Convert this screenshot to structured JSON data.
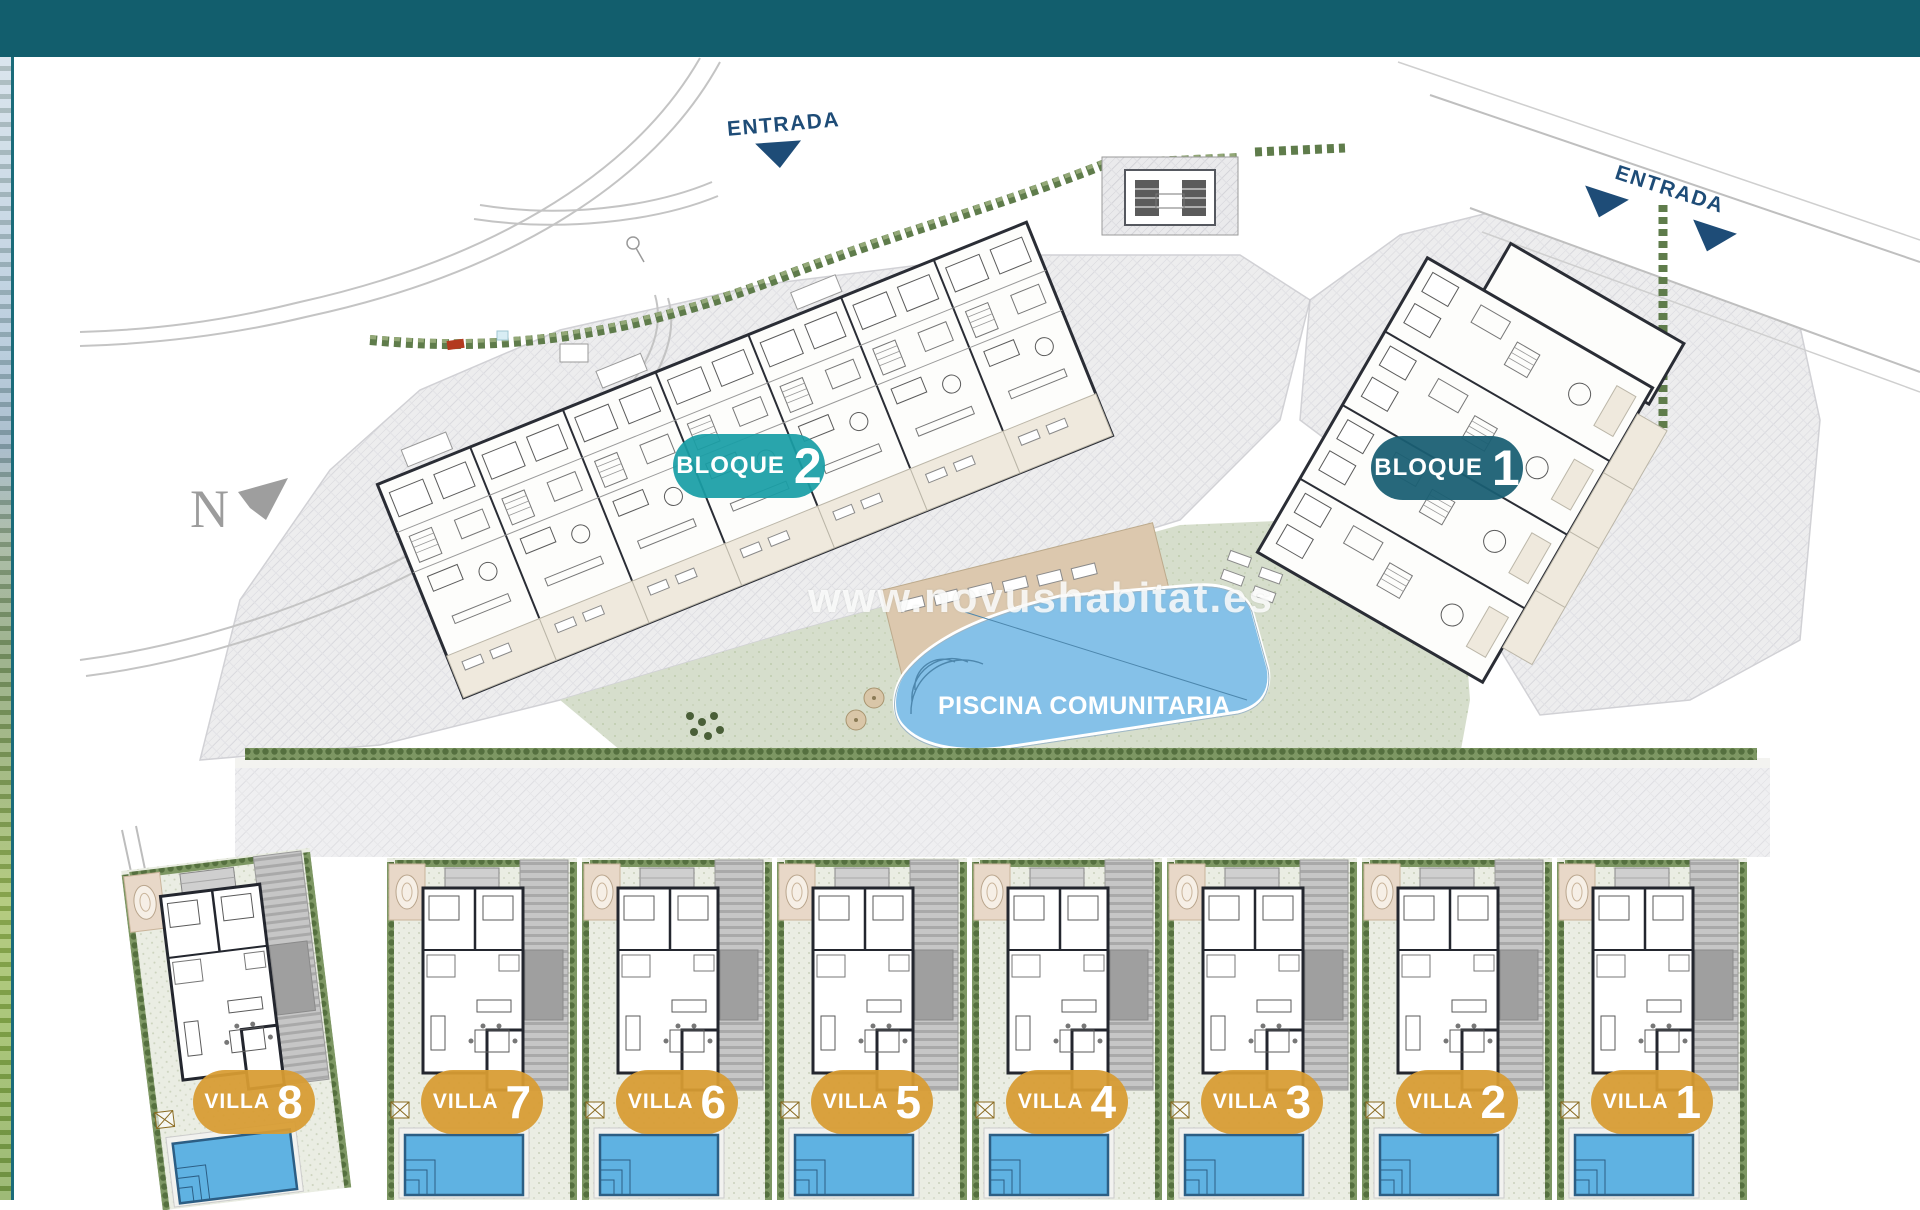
{
  "site_plan": {
    "compass": {
      "label": "N"
    },
    "entrances": [
      {
        "label": "ENTRADA"
      },
      {
        "label": "ENTRADA"
      }
    ],
    "blocks": [
      {
        "label": "BLOQUE",
        "number": "2",
        "badge_color": "#199EA6"
      },
      {
        "label": "BLOQUE",
        "number": "1",
        "badge_color": "#1A5F73"
      }
    ],
    "community_pool": {
      "label": "PISCINA COMUNITARIA",
      "water_color": "#85C1E8"
    },
    "villas": [
      {
        "label": "VILLA",
        "number": "8"
      },
      {
        "label": "VILLA",
        "number": "7"
      },
      {
        "label": "VILLA",
        "number": "6"
      },
      {
        "label": "VILLA",
        "number": "5"
      },
      {
        "label": "VILLA",
        "number": "4"
      },
      {
        "label": "VILLA",
        "number": "3"
      },
      {
        "label": "VILLA",
        "number": "2"
      },
      {
        "label": "VILLA",
        "number": "1"
      }
    ],
    "watermark": {
      "text": "www.novushabitat.es"
    },
    "theme": {
      "header_bar_color": "#125E6D",
      "entrance_label_color": "#1E4C77",
      "villa_badge_color": "#D89C33",
      "villa_pool_color": "#5FB2E2",
      "hedge_color": "#66804E",
      "paving_color": "#E9E9EB",
      "lawn_color": "#D6DECC",
      "deck_color": "#DCC8AE"
    }
  }
}
